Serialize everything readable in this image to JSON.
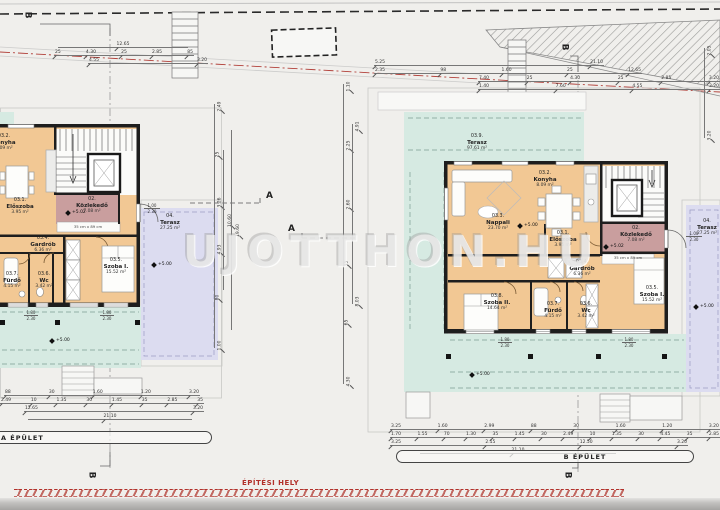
{
  "watermark": "UJOTTHON.HU",
  "site_label": "ÉPÍTÉSI HELY",
  "banners": {
    "a": "A ÉPÜLET",
    "b": "B ÉPÜLET"
  },
  "section_markers": {
    "a": "A",
    "b": "B"
  },
  "levels": {
    "terrace": "+5.00",
    "corridor": "+5.02"
  },
  "notes": {
    "stair": "35 cm x 89 cm",
    "door_w": "1.00",
    "door_h": "2.30",
    "win_w": "1.80",
    "win_h": "2.30"
  },
  "rooms": {
    "a": {
      "konyha": {
        "id": "03.2.",
        "name": "Konyha",
        "area": "8.09 m²"
      },
      "eloszoba": {
        "id": "03.1.",
        "name": "Előszoba",
        "area": "3.95 m²"
      },
      "kozlekedo": {
        "id": "02.",
        "name": "Közlekedő",
        "area": "7.08 m²"
      },
      "gardrob": {
        "id": "03.4.",
        "name": "Gardrób",
        "area": "6.36 m²"
      },
      "szoba1": {
        "id": "03.5.",
        "name": "Szoba I.",
        "area": "15.52 m²"
      },
      "furdo": {
        "id": "03.7.",
        "name": "Fürdő",
        "area": "4.15 m²"
      },
      "wc": {
        "id": "03.6.",
        "name": "Wc",
        "area": "3.42 m²"
      },
      "terasz": {
        "id": "04.",
        "name": "Terasz",
        "area": "27.25 m²"
      }
    },
    "b": {
      "terasz9": {
        "id": "03.9.",
        "name": "Terasz",
        "area": "97.61 m²"
      },
      "konyha": {
        "id": "03.2.",
        "name": "Konyha",
        "area": "8.09 m²"
      },
      "nappali": {
        "id": "03.3.",
        "name": "Nappali",
        "area": "23.70 m²"
      },
      "eloszoba": {
        "id": "03.1.",
        "name": "Előszoba",
        "area": "3.95 m²"
      },
      "kozlekedo": {
        "id": "02.",
        "name": "Közlekedő",
        "area": "7.08 m²"
      },
      "gardrob": {
        "id": "03.4.",
        "name": "Gardrób",
        "area": "6.36 m²"
      },
      "szoba2": {
        "id": "03.8.",
        "name": "Szoba II.",
        "area": "14.64 m²"
      },
      "furdo": {
        "id": "03.7.",
        "name": "Fürdő",
        "area": "4.15 m²"
      },
      "wc": {
        "id": "03.6.",
        "name": "Wc",
        "area": "3.42 m²"
      },
      "szoba1": {
        "id": "03.5.",
        "name": "Szoba I.",
        "area": "15.52 m²"
      },
      "terasz": {
        "id": "04.",
        "name": "Terasz",
        "area": "27.25 m²"
      }
    }
  },
  "dims": {
    "top_a1": [
      "12.65"
    ],
    "top_a2": [
      "25",
      "4.30",
      "25",
      "2.85",
      "85"
    ],
    "top_a3": [
      "4.55",
      "3.20"
    ],
    "top_b1": [
      "5.25",
      "21.10"
    ],
    "top_b2": [
      "2.35",
      "98",
      "1.60",
      "25",
      "12.65"
    ],
    "top_b3": [
      "7.40",
      "25",
      "4.30",
      "25",
      "2.85",
      "3.20"
    ],
    "top_b4": [
      "1.40",
      "7.60",
      "4.55",
      "3.20"
    ],
    "bot_a1": [
      "88",
      "30",
      "1.60",
      "1.20",
      "3.20"
    ],
    "bot_a2": [
      "2.49",
      "10",
      "1.35",
      "30",
      "1.45",
      "35",
      "2.85",
      "35"
    ],
    "bot_a3": [
      "12.65",
      "3.20"
    ],
    "bot_a4": [
      "21.10"
    ],
    "bot_b1": [
      "3.25",
      "1.60",
      "2.99",
      "88",
      "30",
      "1.60",
      "1.20",
      "3.20"
    ],
    "bot_b2": [
      "1.70",
      "1.55",
      "70",
      "1.30",
      "35",
      "1.45",
      "30",
      "2.49",
      "10",
      "1.35",
      "30",
      "4.45",
      "35",
      "2.85"
    ],
    "bot_b3": [
      "3.25",
      "2.15",
      "12.50",
      "3.20"
    ],
    "bot_b4": [
      "21.10"
    ],
    "mid_v1": [
      "2.49",
      "25",
      "3.26",
      "4.93",
      "80",
      "1.00"
    ],
    "mid_v2": [
      "10.60"
    ],
    "mid_v3": [
      "19.60"
    ],
    "b_v1": [
      "1.10",
      "2.25",
      "2.60",
      "35",
      "65",
      "4.30"
    ],
    "b_v2": [
      "4.91",
      "8.03"
    ],
    "right_v": [
      "2.05",
      "3.20"
    ]
  }
}
